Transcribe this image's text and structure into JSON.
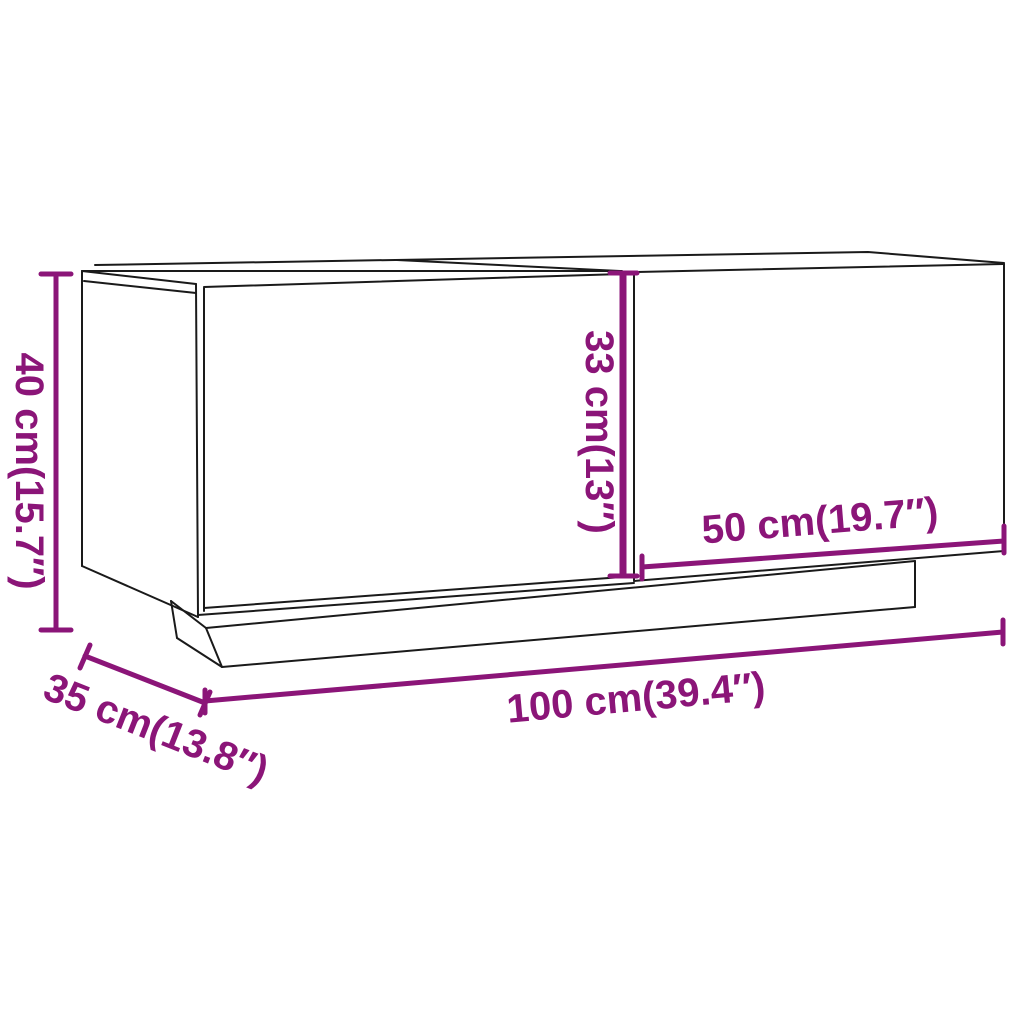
{
  "page": {
    "background": "#ffffff"
  },
  "diagram": {
    "type": "product-dimension-diagram",
    "product": "tv-cabinet-two-doors-with-plinth",
    "line_color": "#1a1a1a",
    "dimension_color": "#8b1578",
    "dimensions": {
      "height": {
        "cm": "40",
        "inch": "15.7",
        "label": "40 cm(15.7″)"
      },
      "inner_height": {
        "cm": "33",
        "inch": "13",
        "label": "33 cm(13″)"
      },
      "door_width": {
        "cm": "50",
        "inch": "19.7",
        "label": "50 cm(19.7″)"
      },
      "width": {
        "cm": "100",
        "inch": "39.4",
        "label": "100 cm(39.4″)"
      },
      "depth": {
        "cm": "35",
        "inch": "13.8",
        "label": "35 cm(13.8″)"
      }
    }
  }
}
